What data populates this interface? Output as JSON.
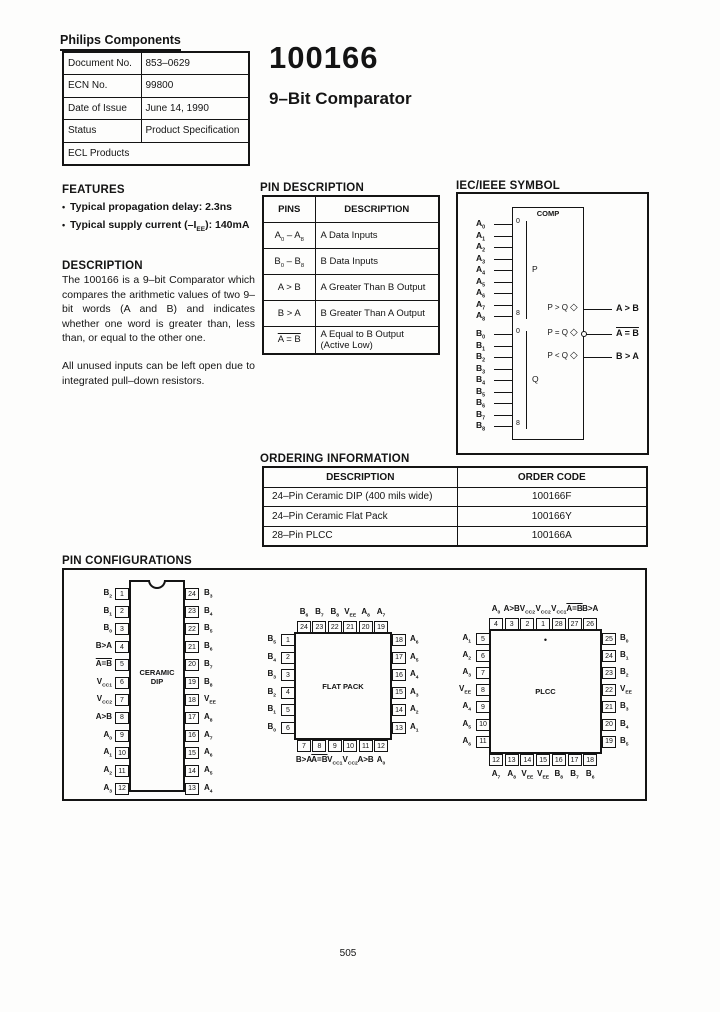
{
  "page": {
    "number": "505"
  },
  "brand": "Philips Components",
  "doc_info": {
    "rows": [
      {
        "label": "Document No.",
        "value": "853–0629"
      },
      {
        "label": "ECN No.",
        "value": "99800"
      },
      {
        "label": "Date of Issue",
        "value": "June 14, 1990"
      },
      {
        "label": "Status",
        "value": "Product Specification"
      }
    ],
    "footer": "ECL Products"
  },
  "title": {
    "part_number": "100166",
    "subtitle": "9–Bit Comparator"
  },
  "features": {
    "heading": "FEATURES",
    "bullet_icon": "•",
    "items": [
      "Typical propagation delay: 2.3ns",
      "Typical supply current (–I_{EE}): 140mA"
    ]
  },
  "description": {
    "heading": "DESCRIPTION",
    "paragraphs": [
      "The 100166 is a 9–bit Comparator which compares the arithmetic values of two 9–bit words (A and B) and indicates whether one word is greater than, less than, or equal to the other one.",
      "All unused inputs can be left open due to integrated pull–down resistors."
    ]
  },
  "pin_description": {
    "heading": "PIN DESCRIPTION",
    "columns": [
      "PINS",
      "DESCRIPTION"
    ],
    "rows": [
      {
        "pins": "A_{0} – A_{8}",
        "desc": "A Data Inputs"
      },
      {
        "pins": "B_{0} – B_{8}",
        "desc": "B Data Inputs"
      },
      {
        "pins": "A > B",
        "desc": "A Greater Than B Output"
      },
      {
        "pins": "B > A",
        "desc": "B Greater Than A Output"
      },
      {
        "pins": "~A = B~",
        "desc": "A Equal to B Output (Active Low)"
      }
    ]
  },
  "iec_symbol": {
    "heading": "IEC/IEEE SYMBOL",
    "comp_label": "COMP",
    "polarity_icon": "◇",
    "a_inputs": [
      "A_{0}",
      "A_{1}",
      "A_{2}",
      "A_{3}",
      "A_{4}",
      "A_{5}",
      "A_{6}",
      "A_{7}",
      "A_{8}"
    ],
    "b_inputs": [
      "B_{0}",
      "B_{1}",
      "B_{2}",
      "B_{3}",
      "B_{4}",
      "B_{5}",
      "B_{6}",
      "B_{7}",
      "B_{8}"
    ],
    "a_group": {
      "top_marker": "0",
      "bottom_marker": "8",
      "label": "P"
    },
    "b_group": {
      "top_marker": "0",
      "bottom_marker": "8",
      "label": "Q"
    },
    "outputs": [
      {
        "inner": "P > Q",
        "outer": "A > B",
        "bubble": false
      },
      {
        "inner": "P = Q",
        "outer": "~A = B~",
        "bubble": true
      },
      {
        "inner": "P < Q",
        "outer": "B > A",
        "bubble": false
      }
    ]
  },
  "ordering": {
    "heading": "ORDERING INFORMATION",
    "columns": [
      "DESCRIPTION",
      "ORDER CODE"
    ],
    "rows": [
      {
        "description": "24–Pin Ceramic DIP (400 mils wide)",
        "code": "100166F"
      },
      {
        "description": "24–Pin Ceramic Flat Pack",
        "code": "100166Y"
      },
      {
        "description": "28–Pin PLCC",
        "code": "100166A"
      }
    ]
  },
  "pin_configurations": {
    "heading": "PIN CONFIGURATIONS",
    "dip": {
      "name": "CERAMIC\nDIP",
      "left": [
        {
          "pin": "1",
          "label": "B_{2}"
        },
        {
          "pin": "2",
          "label": "B_{1}"
        },
        {
          "pin": "3",
          "label": "B_{0}"
        },
        {
          "pin": "4",
          "label": "B>A"
        },
        {
          "pin": "5",
          "label": "~A=B~"
        },
        {
          "pin": "6",
          "label": "V_{CC1}"
        },
        {
          "pin": "7",
          "label": "V_{CC2}"
        },
        {
          "pin": "8",
          "label": "A>B"
        },
        {
          "pin": "9",
          "label": "A_{0}"
        },
        {
          "pin": "10",
          "label": "A_{1}"
        },
        {
          "pin": "11",
          "label": "A_{2}"
        },
        {
          "pin": "12",
          "label": "A_{3}"
        }
      ],
      "right": [
        {
          "pin": "24",
          "label": "B_{3}"
        },
        {
          "pin": "23",
          "label": "B_{4}"
        },
        {
          "pin": "22",
          "label": "B_{5}"
        },
        {
          "pin": "21",
          "label": "B_{6}"
        },
        {
          "pin": "20",
          "label": "B_{7}"
        },
        {
          "pin": "19",
          "label": "B_{8}"
        },
        {
          "pin": "18",
          "label": "V_{EE}"
        },
        {
          "pin": "17",
          "label": "A_{8}"
        },
        {
          "pin": "16",
          "label": "A_{7}"
        },
        {
          "pin": "15",
          "label": "A_{6}"
        },
        {
          "pin": "14",
          "label": "A_{5}"
        },
        {
          "pin": "13",
          "label": "A_{4}"
        }
      ]
    },
    "flatpack": {
      "name": "FLAT PACK",
      "top": [
        {
          "pin": "24",
          "label": "B_{6}"
        },
        {
          "pin": "23",
          "label": "B_{7}"
        },
        {
          "pin": "22",
          "label": "B_{8}"
        },
        {
          "pin": "21",
          "label": "V_{EE}"
        },
        {
          "pin": "20",
          "label": "A_{8}"
        },
        {
          "pin": "19",
          "label": "A_{7}"
        }
      ],
      "left": [
        {
          "pin": "1",
          "label": "B_{5}"
        },
        {
          "pin": "2",
          "label": "B_{4}"
        },
        {
          "pin": "3",
          "label": "B_{3}"
        },
        {
          "pin": "4",
          "label": "B_{2}"
        },
        {
          "pin": "5",
          "label": "B_{1}"
        },
        {
          "pin": "6",
          "label": "B_{0}"
        }
      ],
      "right": [
        {
          "pin": "18",
          "label": "A_{6}"
        },
        {
          "pin": "17",
          "label": "A_{5}"
        },
        {
          "pin": "16",
          "label": "A_{4}"
        },
        {
          "pin": "15",
          "label": "A_{3}"
        },
        {
          "pin": "14",
          "label": "A_{2}"
        },
        {
          "pin": "13",
          "label": "A_{1}"
        }
      ],
      "bottom": [
        {
          "pin": "7",
          "label": "B>A"
        },
        {
          "pin": "8",
          "label": "~A=B~"
        },
        {
          "pin": "9",
          "label": "V_{CC1}"
        },
        {
          "pin": "10",
          "label": "V_{CC2}"
        },
        {
          "pin": "11",
          "label": "A>B"
        },
        {
          "pin": "12",
          "label": "A_{0}"
        }
      ]
    },
    "plcc": {
      "name": "PLCC",
      "pin1_marker": "•",
      "top": [
        {
          "pin": "4",
          "label": "A_{0}"
        },
        {
          "pin": "3",
          "label": "A>B"
        },
        {
          "pin": "2",
          "label": "V_{CC2}"
        },
        {
          "pin": "1",
          "label": "V_{CC2}"
        },
        {
          "pin": "28",
          "label": "V_{CC1}"
        },
        {
          "pin": "27",
          "label": "~A=B~"
        },
        {
          "pin": "26",
          "label": "B>A"
        }
      ],
      "left": [
        {
          "pin": "5",
          "label": "A_{1}"
        },
        {
          "pin": "6",
          "label": "A_{2}"
        },
        {
          "pin": "7",
          "label": "A_{3}"
        },
        {
          "pin": "8",
          "label": "V_{EE}"
        },
        {
          "pin": "9",
          "label": "A_{4}"
        },
        {
          "pin": "10",
          "label": "A_{5}"
        },
        {
          "pin": "11",
          "label": "A_{6}"
        }
      ],
      "right": [
        {
          "pin": "25",
          "label": "B_{0}"
        },
        {
          "pin": "24",
          "label": "B_{1}"
        },
        {
          "pin": "23",
          "label": "B_{2}"
        },
        {
          "pin": "22",
          "label": "V_{EE}"
        },
        {
          "pin": "21",
          "label": "B_{3}"
        },
        {
          "pin": "20",
          "label": "B_{4}"
        },
        {
          "pin": "19",
          "label": "B_{5}"
        }
      ],
      "bottom": [
        {
          "pin": "12",
          "label": "A_{7}"
        },
        {
          "pin": "13",
          "label": "A_{8}"
        },
        {
          "pin": "14",
          "label": "V_{EE}"
        },
        {
          "pin": "15",
          "label": "V_{EE}"
        },
        {
          "pin": "16",
          "label": "B_{8}"
        },
        {
          "pin": "17",
          "label": "B_{7}"
        },
        {
          "pin": "18",
          "label": "B_{6}"
        }
      ]
    }
  }
}
